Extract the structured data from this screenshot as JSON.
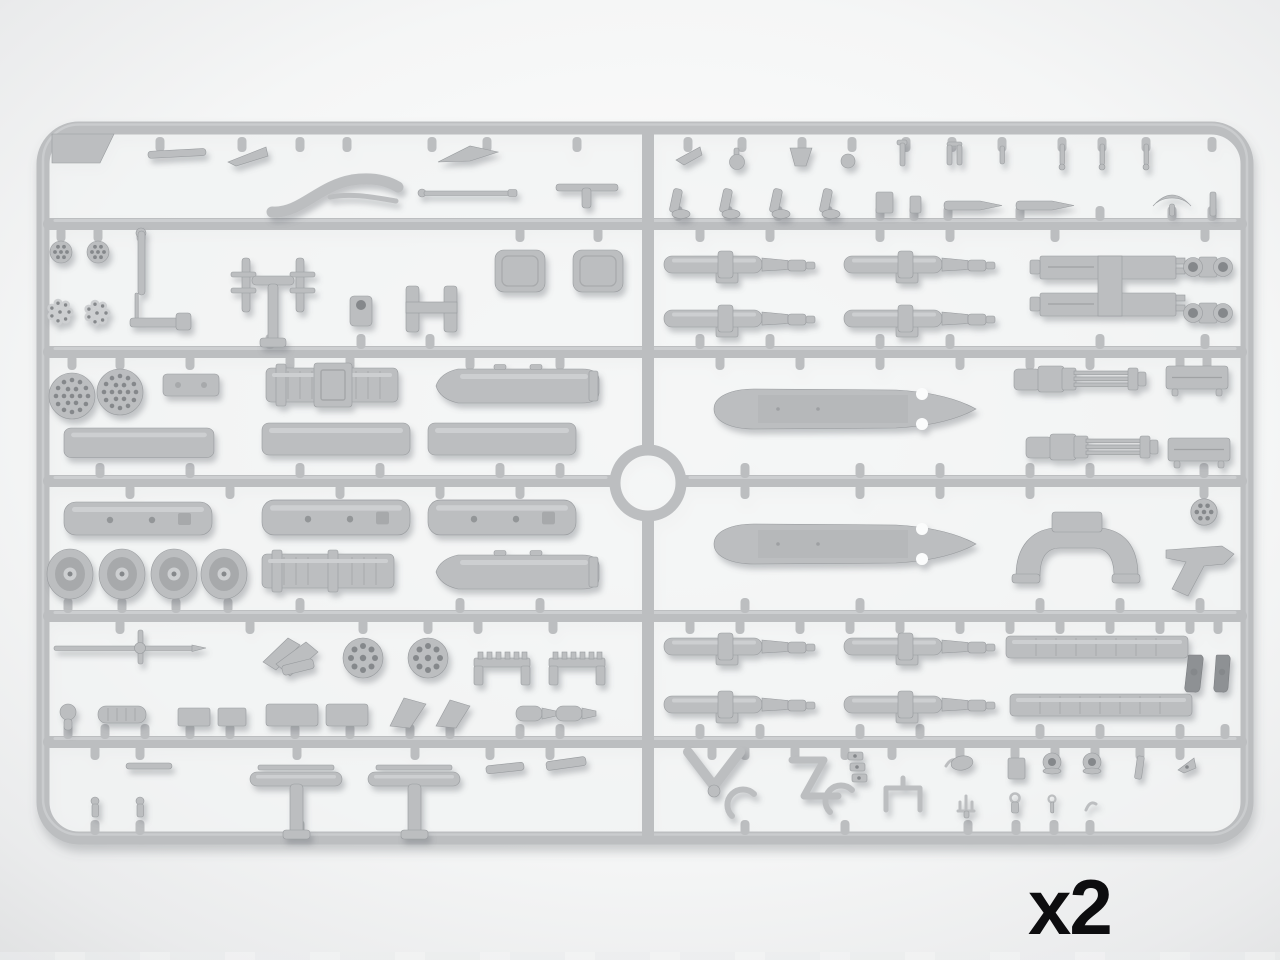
{
  "scene": {
    "type": "product-photo",
    "subject": "grey injection-molded styrene sprue (parts frame) with helicopter weapon and detail parts, shown top-down on a white surface",
    "quantity_label": "x2",
    "colors": {
      "background_center": "#ffffff",
      "background_edge": "#d7d8d9",
      "plastic": "#bcbec0",
      "plastic_highlight": "#cdcfd1",
      "plastic_shadow": "#a7a9ab",
      "hole_dark": "#85888b",
      "dark_part": "#8e9194",
      "label_color": "#0d0d0f"
    }
  },
  "sprue": {
    "frame": "rounded rectangle with six horizontal rails, central vertical rail and central molding ring",
    "corner_tab": "blank marking plate in top-left corner",
    "parts_inventory": [
      "corner-marking-plate",
      "canopy-frame-rail",
      "antenna-and-pitot-rods",
      "rocket-pod-faceplates-perforated",
      "rocket-pod-rear-plates-clustered",
      "rocket-pod-tube-bodies",
      "rocket-pod-bodies-with-studs",
      "rocket-pod-halves-with-nose-cone",
      "ribbed-launcher-bodies",
      "road-wheels",
      "fuel-tank-halves",
      "gatling-miniguns",
      "gun-barrel-assemblies",
      "twin-mg-mount-frame",
      "turret-yoke-mount",
      "pistol-grip-bracket",
      "ammunition-boxes",
      "sight-ring-pairs",
      "landing-skid-tubes",
      "small-brackets-pins-and-clips"
    ]
  }
}
